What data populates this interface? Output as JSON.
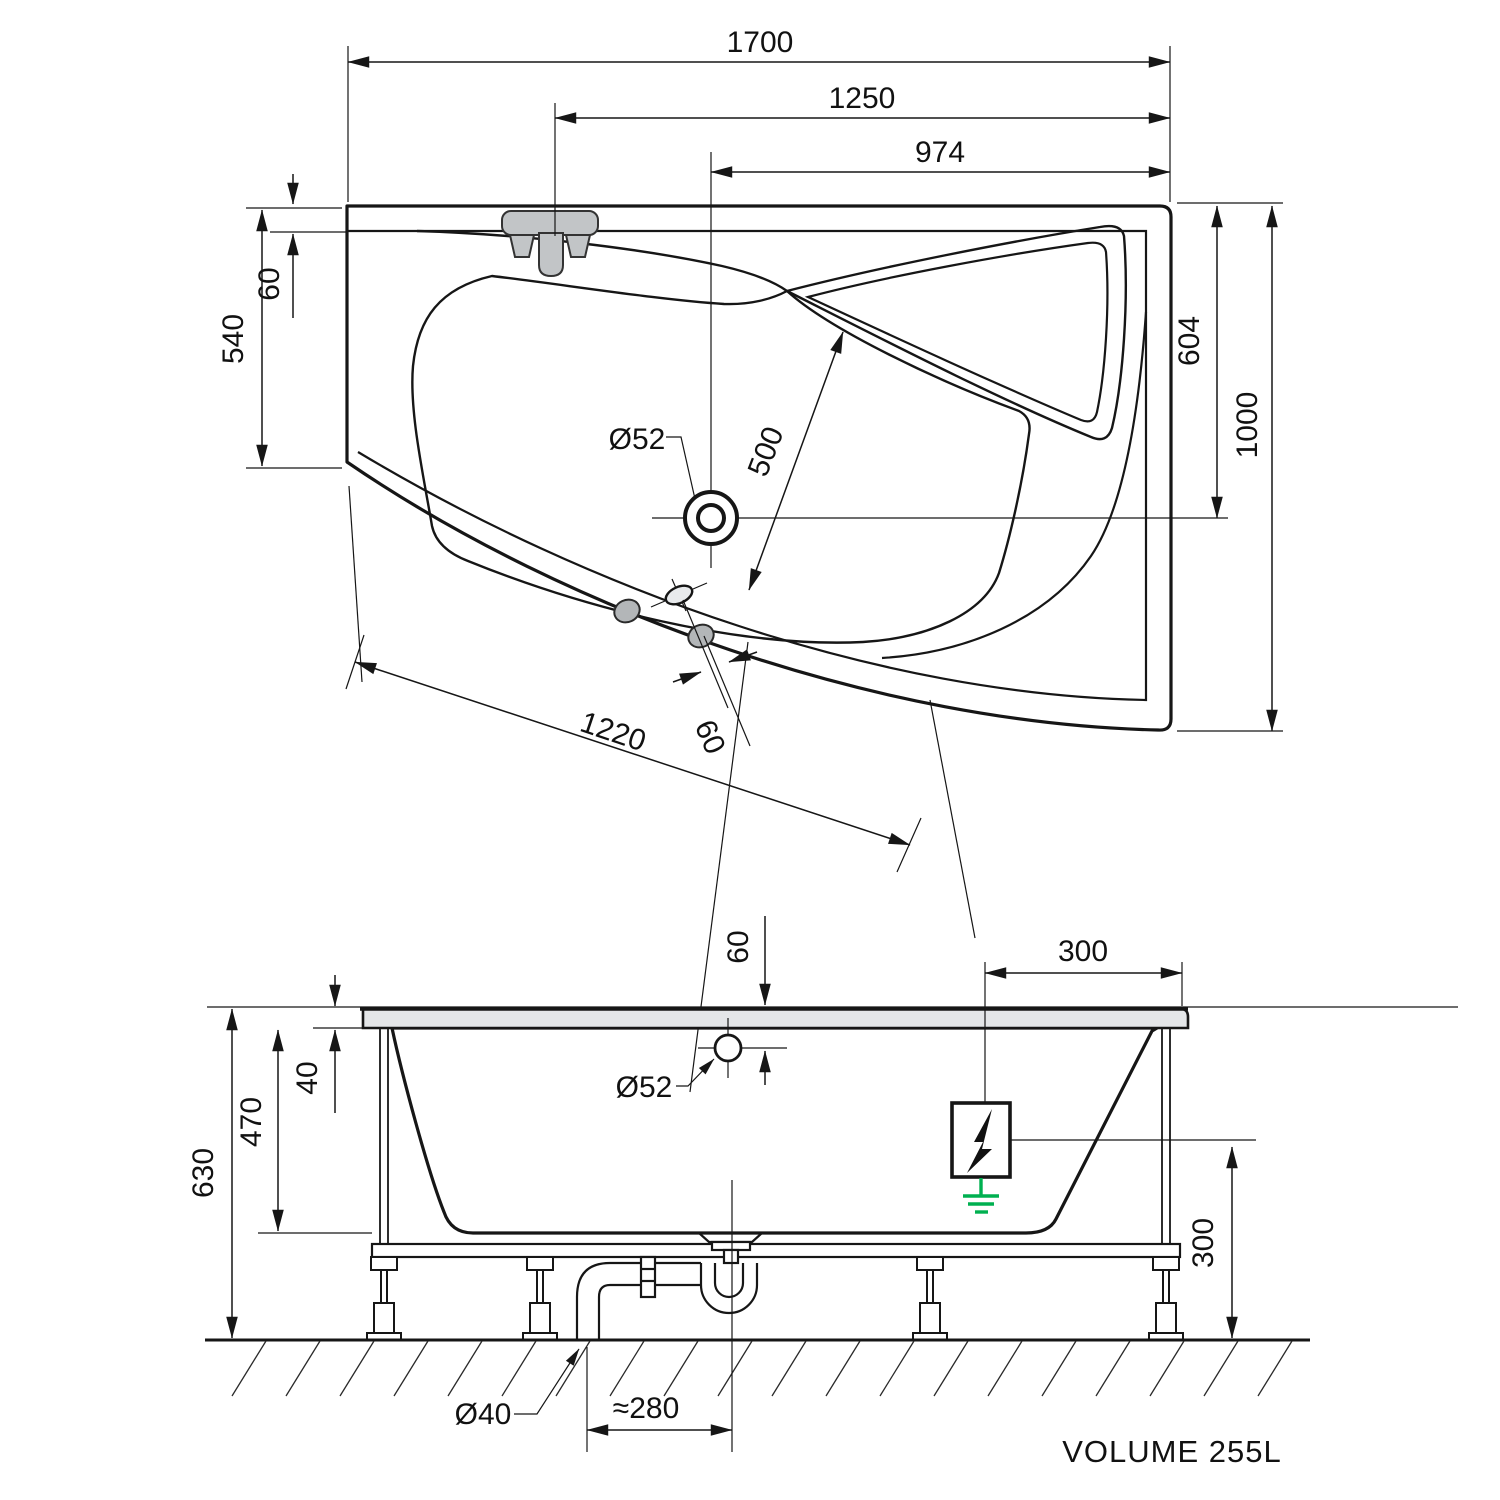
{
  "drawing": {
    "volume_label": "VOLUME 255L",
    "plan": {
      "dim_total_length": "1700",
      "dim_faucet_from_right": "1250",
      "dim_drain_from_right": "974",
      "dim_left_side_depth": "540",
      "dim_rim_offset": "60",
      "dim_drain_from_top": "604",
      "dim_total_width": "1000",
      "dim_drain_diameter": "Ø52",
      "dim_drain_diagonal": "500",
      "dim_bottom_edge": "1220",
      "dim_jet_offset": "60"
    },
    "side": {
      "dim_overflow_from_top": "60",
      "dim_rim_height": "40",
      "dim_inner_depth": "470",
      "dim_total_height": "630",
      "dim_overflow_diameter": "Ø52",
      "dim_bond_from_edge": "300",
      "dim_bond_height": "300",
      "dim_waste_pipe_diameter": "Ø40",
      "dim_trap_offset": "≈280"
    },
    "colors": {
      "line": "#161616",
      "tub_fill": "#e8eaec",
      "ground_green": "#00b050"
    }
  }
}
